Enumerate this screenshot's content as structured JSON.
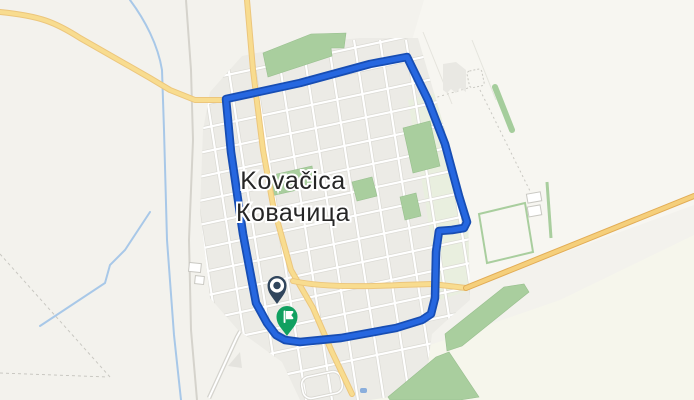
{
  "map": {
    "type": "route-map",
    "place": {
      "name_latin": "Kovačica",
      "name_cyrillic": "Ковачица"
    },
    "route": {
      "path": "M226,99 L300,83 370,64 407,57 L428,100 445,144 459,196 467,222 L464,228 452,230 439,231 L436,252 435,298 431,314 L422,320 396,328 341,338 300,342 285,340 L276,335 267,323 256,303 243,234 231,152 Z",
      "color": "#2667E0",
      "casing_color": "#174DB3"
    },
    "markers": {
      "start": {
        "label": "route-start",
        "icon": "circle-ring",
        "color": "#30455C",
        "x": 277,
        "y": 304
      },
      "end": {
        "label": "route-end",
        "icon": "flag",
        "color": "#11A060",
        "x": 287,
        "y": 336
      }
    },
    "palette": {
      "background": "#F3F2ED",
      "outskirts_ne": "#F7F6F1",
      "outskirts_se": "#F6F6EC",
      "town_block": "#ECEBE6",
      "town_block_green": "#E9EFDF",
      "street_fill": "#FFFFFF",
      "street_casing": "#DBDAD4",
      "road_fill": "#F8DC8F",
      "road_casing": "#ECC67C",
      "highway_fill": "#F5CF7B",
      "highway_casing": "#E2AC55",
      "green_area": "#A9CE9E",
      "green_outline": "#98BF8E",
      "water": "#A8C8E8",
      "railway": "#D5D3CC",
      "parcel_line": "#C9C8C2",
      "building": "#E9E8E3",
      "label_color": "#262626"
    }
  }
}
